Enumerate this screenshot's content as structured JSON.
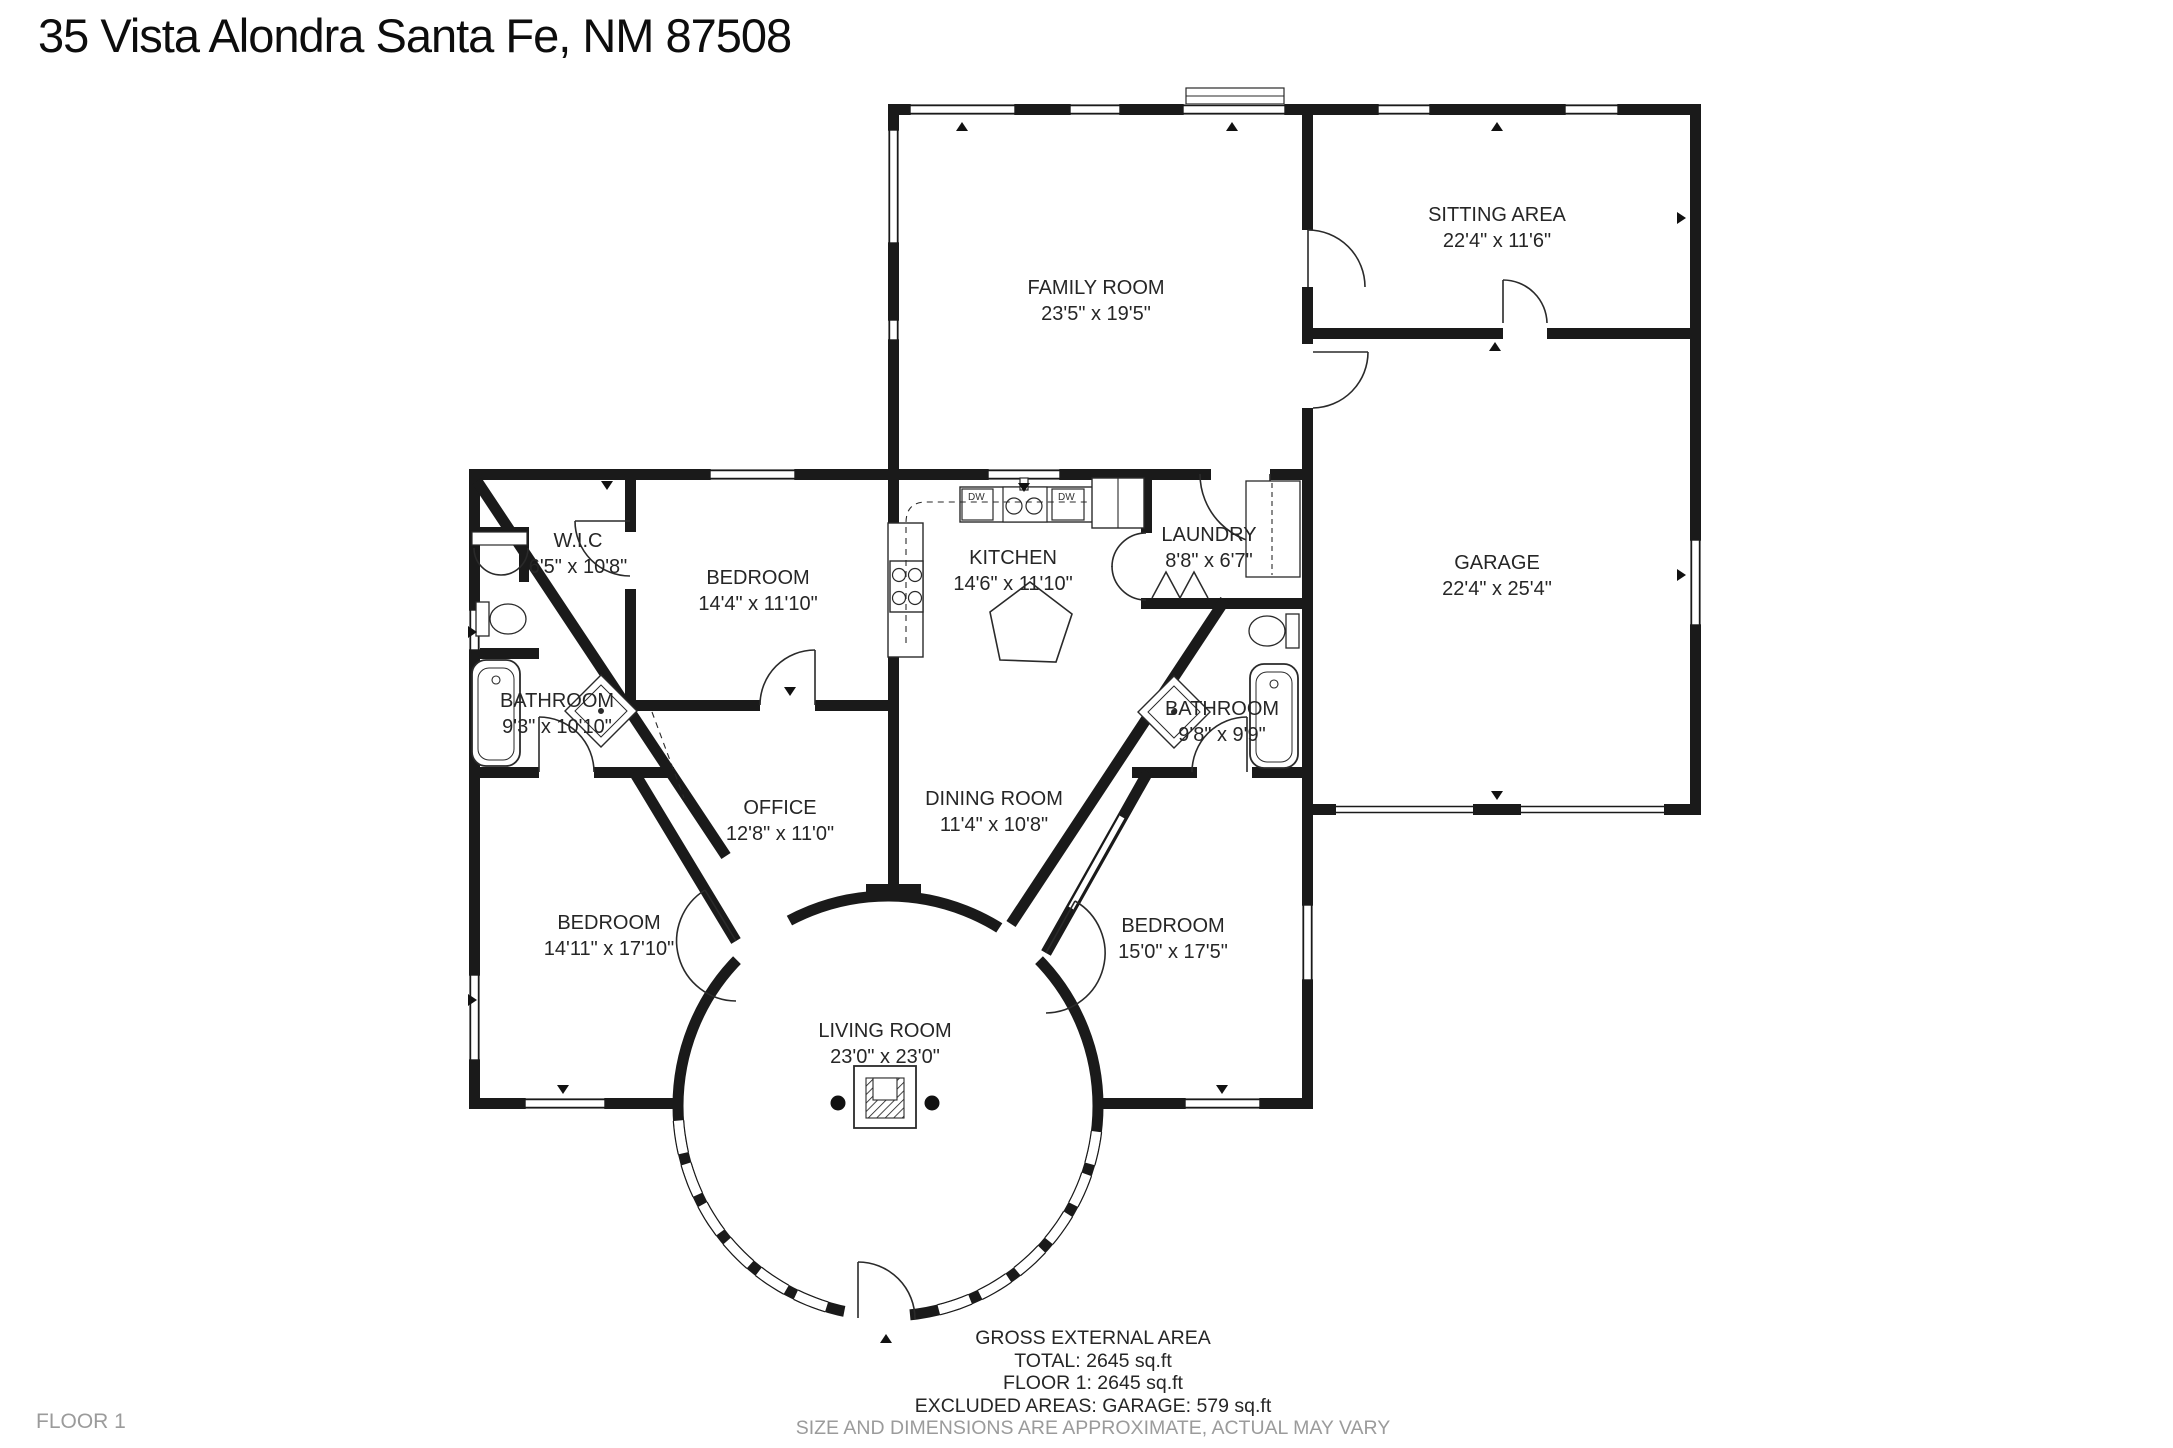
{
  "title": "35 Vista Alondra Santa Fe, NM 87508",
  "floor_label": "FLOOR 1",
  "rooms": [
    {
      "id": "family-room",
      "name": "FAMILY ROOM",
      "dims": "23'5\" x 19'5\""
    },
    {
      "id": "sitting-area",
      "name": "SITTING AREA",
      "dims": "22'4\" x 11'6\""
    },
    {
      "id": "garage",
      "name": "GARAGE",
      "dims": "22'4\" x 25'4\""
    },
    {
      "id": "wic",
      "name": "W.I.C",
      "dims": "6'5\" x 10'8\""
    },
    {
      "id": "bedroom-upper",
      "name": "BEDROOM",
      "dims": "14'4\" x 11'10\""
    },
    {
      "id": "kitchen",
      "name": "KITCHEN",
      "dims": "14'6\" x 11'10\""
    },
    {
      "id": "laundry",
      "name": "LAUNDRY",
      "dims": "8'8\" x 6'7\""
    },
    {
      "id": "bathroom-left",
      "name": "BATHROOM",
      "dims": "9'3\" x 10'10\""
    },
    {
      "id": "bathroom-right",
      "name": "BATHROOM",
      "dims": "9'8\" x 9'9\""
    },
    {
      "id": "office",
      "name": "OFFICE",
      "dims": "12'8\" x 11'0\""
    },
    {
      "id": "dining-room",
      "name": "DINING ROOM",
      "dims": "11'4\" x 10'8\""
    },
    {
      "id": "bedroom-left",
      "name": "BEDROOM",
      "dims": "14'11\" x 17'10\""
    },
    {
      "id": "bedroom-right",
      "name": "BEDROOM",
      "dims": "15'0\" x 17'5\""
    },
    {
      "id": "living-room",
      "name": "LIVING ROOM",
      "dims": "23'0\" x 23'0\""
    }
  ],
  "appliance_labels": {
    "dishwasher_left": "DW",
    "dishwasher_right": "DW"
  },
  "fixtures": [
    "bathtub-left",
    "toilet-left",
    "shower-left",
    "closet-double-doors",
    "bathtub-right",
    "toilet-right",
    "shower-right",
    "stove",
    "kitchen-sink",
    "kitchen-island",
    "fridge",
    "laundry-closet",
    "fireplace",
    "entry-steps"
  ],
  "footer": {
    "area_title": "GROSS EXTERNAL AREA",
    "total": "TOTAL: 2645 sq.ft",
    "floor1": "FLOOR 1: 2645 sq.ft",
    "excluded": "EXCLUDED AREAS: GARAGE: 579 sq.ft",
    "disclaimer": "SIZE AND DIMENSIONS ARE APPROXIMATE, ACTUAL MAY VARY"
  },
  "colors": {
    "wall": "#1a1a1a",
    "text": "#262626",
    "muted": "#9b9b9b",
    "background": "#ffffff"
  }
}
